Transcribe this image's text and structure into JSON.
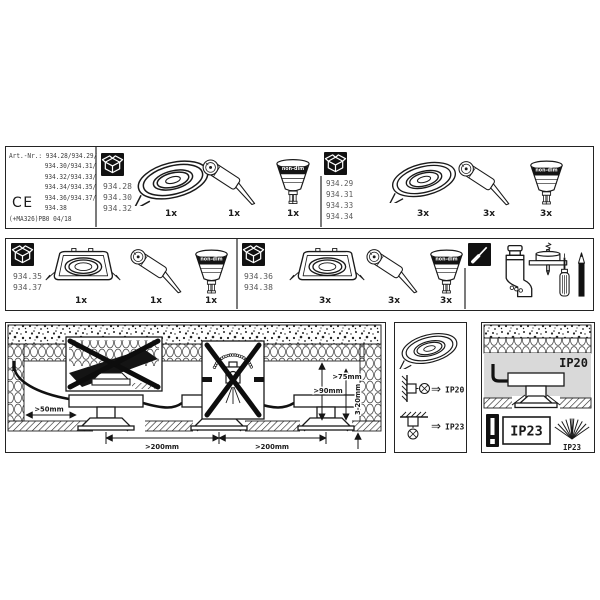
{
  "sheet": {
    "art": {
      "line1": "Art.-Nr.: 934.28/934.29/",
      "lines": [
        "934.30/934.31/",
        "934.32/934.33/",
        "934.34/934.35/",
        "934.36/934.37/",
        "934.38"
      ],
      "ce": "CE",
      "code": "(+MA326)PB0 04/18"
    },
    "row1": {
      "set1": {
        "box_contents": [
          "934.28",
          "934.30",
          "934.32"
        ],
        "fixture_qty": "1x",
        "socket_qty": "1x",
        "lamp_qty": "1x",
        "lamp_band": "non-dim"
      },
      "set2": {
        "box_contents": [
          "934.29",
          "934.31",
          "934.33",
          "934.34"
        ],
        "fixture_qty": "3x",
        "socket_qty": "3x",
        "lamp_qty": "3x",
        "lamp_band": "non-dim"
      }
    },
    "row2": {
      "set1": {
        "box_contents": [
          "934.35",
          "934.37"
        ],
        "fixture_qty": "1x",
        "socket_qty": "1x",
        "lamp_qty": "1x",
        "lamp_band": "non-dim"
      },
      "set2": {
        "box_contents": [
          "934.36",
          "934.38"
        ],
        "fixture_qty": "3x",
        "socket_qty": "3x",
        "lamp_qty": "3x",
        "lamp_band": "non-dim"
      }
    },
    "install": {
      "gap_side": ">50mm",
      "spacing_1": ">200mm",
      "spacing_2": ">200mm",
      "clearance_top": ">90mm",
      "clearance_min": ">75mm",
      "ceiling_thickness": "3-20mm"
    },
    "ip": {
      "implies": "⇒",
      "wall": "IP20",
      "ceiling": "IP23",
      "cavity": "IP20",
      "warning": "IP23",
      "spray": "IP23"
    },
    "icons": {
      "box": "carton-box-icon",
      "tools": "screwdriver-icon",
      "warning": "exclamation-icon",
      "lamp_symbol": "luminaire-circle-x-icon"
    },
    "colors": {
      "line": "#1a1a1a",
      "muted_text": "#585858",
      "cavity_gray": "#d9d9d9"
    }
  }
}
